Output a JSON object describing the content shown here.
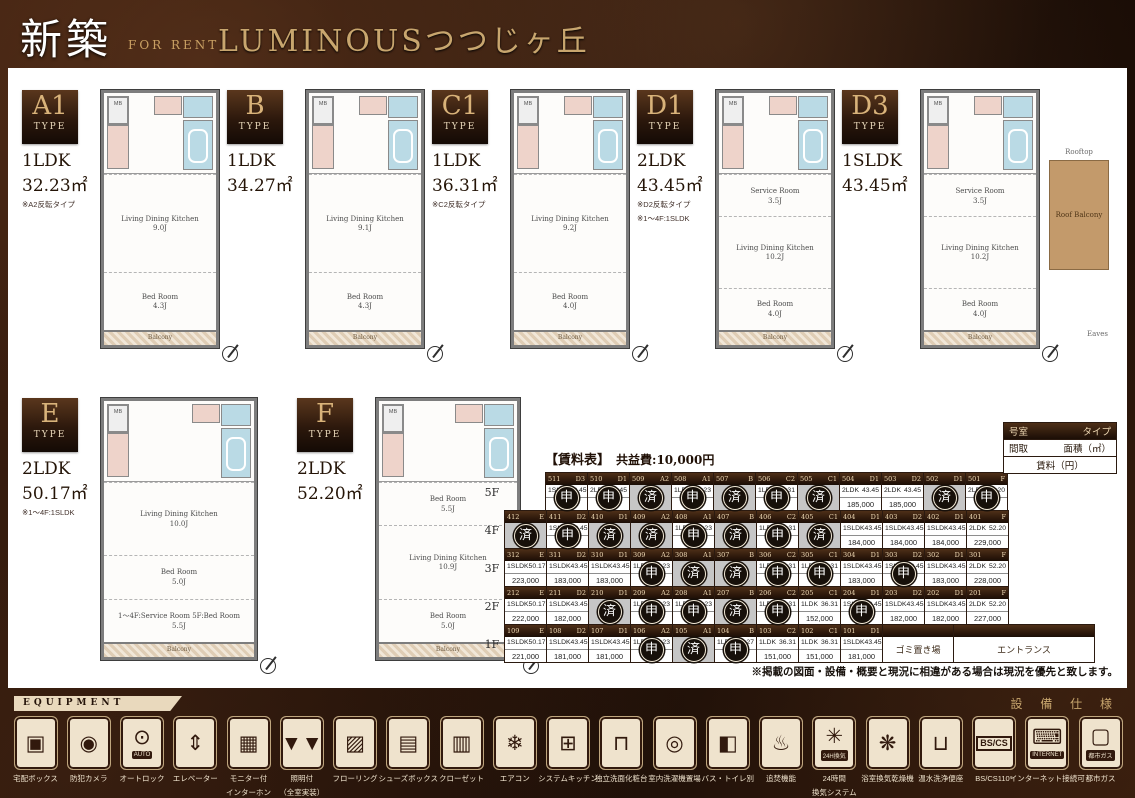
{
  "header": {
    "badge": "新築",
    "for_rent": "FOR RENT",
    "title": "LUMINOUSつつじヶ丘"
  },
  "plan_common": {
    "mb": "MB",
    "balcony": "Balcony"
  },
  "plans": [
    {
      "code": "A1",
      "type_word": "TYPE",
      "layout": "1LDK",
      "area": "32.23㎡",
      "notes": [
        "※A2反転タイプ"
      ],
      "rooms": [
        {
          "name": "Living Dining Kitchen",
          "size": "9.0J"
        },
        {
          "name": "Bed Room",
          "size": "4.3J"
        }
      ]
    },
    {
      "code": "B",
      "type_word": "TYPE",
      "layout": "1LDK",
      "area": "34.27㎡",
      "notes": [],
      "rooms": [
        {
          "name": "Living Dining Kitchen",
          "size": "9.1J"
        },
        {
          "name": "Bed Room",
          "size": "4.3J"
        }
      ]
    },
    {
      "code": "C1",
      "type_word": "TYPE",
      "layout": "1LDK",
      "area": "36.31㎡",
      "notes": [
        "※C2反転タイプ"
      ],
      "rooms": [
        {
          "name": "Living Dining Kitchen",
          "size": "9.2J"
        },
        {
          "name": "Bed Room",
          "size": "4.0J"
        }
      ]
    },
    {
      "code": "D1",
      "type_word": "TYPE",
      "layout": "2LDK",
      "area": "43.45㎡",
      "notes": [
        "※D2反転タイプ",
        "※1〜4F:1SLDK"
      ],
      "rooms": [
        {
          "name": "Service Room",
          "size": "3.5J"
        },
        {
          "name": "Living Dining Kitchen",
          "size": "10.2J"
        },
        {
          "name": "Bed Room",
          "size": "4.0J"
        }
      ]
    },
    {
      "code": "D3",
      "type_word": "TYPE",
      "layout": "1SLDK",
      "area": "43.45㎡",
      "notes": [],
      "rooms": [
        {
          "name": "Service Room",
          "size": "3.5J"
        },
        {
          "name": "Living Dining Kitchen",
          "size": "10.2J"
        },
        {
          "name": "Bed Room",
          "size": "4.0J"
        }
      ],
      "extras": {
        "rooftop": "Rooftop",
        "roof_balcony": "Roof Balcony",
        "eaves": "Eaves"
      }
    },
    {
      "code": "E",
      "type_word": "TYPE",
      "layout": "2LDK",
      "area": "50.17㎡",
      "notes": [
        "※1〜4F:1SLDK"
      ],
      "rooms": [
        {
          "name": "Living Dining Kitchen",
          "size": "10.0J"
        },
        {
          "name": "Bed Room",
          "size": "5.0J"
        },
        {
          "name": "1〜4F:Service Room 5F:Bed Room",
          "size": "5.5J"
        }
      ]
    },
    {
      "code": "F",
      "type_word": "TYPE",
      "layout": "2LDK",
      "area": "52.20㎡",
      "notes": [],
      "rooms": [
        {
          "name": "Bed Room",
          "size": "5.5J"
        },
        {
          "name": "Living Dining Kitchen",
          "size": "10.9J"
        },
        {
          "name": "Bed Room",
          "size": "5.0J"
        }
      ]
    }
  ],
  "price_table": {
    "title": "【賃料表】",
    "fee": "共益費:10,000円",
    "legend": {
      "room": "号室",
      "type": "タイプ",
      "madori": "間取",
      "area": "面積（㎡）",
      "rent": "賃料（円）"
    },
    "stamps": {
      "applied": "申",
      "taken": "済"
    },
    "floors": [
      {
        "label": "5F",
        "offset": true,
        "cells": [
          {
            "room": "511",
            "type": "D3",
            "layout": "1SLDK",
            "area": "43.45",
            "price": "",
            "status": "applied"
          },
          {
            "room": "510",
            "type": "D1",
            "layout": "2LDK",
            "area": "43.45",
            "price": "",
            "status": "applied"
          },
          {
            "room": "509",
            "type": "A2",
            "status": "taken"
          },
          {
            "room": "508",
            "type": "A1",
            "layout": "1LDK",
            "area": "32.23",
            "price": "",
            "status": "applied"
          },
          {
            "room": "507",
            "type": "B",
            "status": "taken"
          },
          {
            "room": "506",
            "type": "C2",
            "layout": "1LDK",
            "area": "36.31",
            "price": "",
            "status": "applied"
          },
          {
            "room": "505",
            "type": "C1",
            "status": "taken"
          },
          {
            "room": "504",
            "type": "D1",
            "layout": "2LDK",
            "area": "43.45",
            "price": "185,000",
            "status": "open"
          },
          {
            "room": "503",
            "type": "D2",
            "layout": "2LDK",
            "area": "43.45",
            "price": "185,000",
            "status": "open"
          },
          {
            "room": "502",
            "type": "D1",
            "status": "taken"
          },
          {
            "room": "501",
            "type": "F",
            "layout": "2LDK",
            "area": "52.20",
            "price": "",
            "status": "applied"
          }
        ]
      },
      {
        "label": "4F",
        "cells": [
          {
            "room": "412",
            "type": "E",
            "status": "taken"
          },
          {
            "room": "411",
            "type": "D2",
            "layout": "1SLDK",
            "area": "43.45",
            "price": "",
            "status": "applied"
          },
          {
            "room": "410",
            "type": "D1",
            "status": "taken"
          },
          {
            "room": "409",
            "type": "A2",
            "status": "taken"
          },
          {
            "room": "408",
            "type": "A1",
            "layout": "1LDK",
            "area": "32.23",
            "price": "",
            "status": "applied"
          },
          {
            "room": "407",
            "type": "B",
            "status": "taken"
          },
          {
            "room": "406",
            "type": "C2",
            "layout": "1LDK",
            "area": "36.31",
            "price": "",
            "status": "applied"
          },
          {
            "room": "405",
            "type": "C1",
            "status": "taken"
          },
          {
            "room": "404",
            "type": "D1",
            "layout": "1SLDK",
            "area": "43.45",
            "price": "184,000",
            "status": "open"
          },
          {
            "room": "403",
            "type": "D2",
            "layout": "1SLDK",
            "area": "43.45",
            "price": "184,000",
            "status": "open"
          },
          {
            "room": "402",
            "type": "D1",
            "layout": "1SLDK",
            "area": "43.45",
            "price": "184,000",
            "status": "open"
          },
          {
            "room": "401",
            "type": "F",
            "layout": "2LDK",
            "area": "52.20",
            "price": "229,000",
            "status": "open"
          }
        ]
      },
      {
        "label": "3F",
        "cells": [
          {
            "room": "312",
            "type": "E",
            "layout": "1SLDK",
            "area": "50.17",
            "price": "223,000",
            "status": "open"
          },
          {
            "room": "311",
            "type": "D2",
            "layout": "1SLDK",
            "area": "43.45",
            "price": "183,000",
            "status": "open"
          },
          {
            "room": "310",
            "type": "D1",
            "layout": "1SLDK",
            "area": "43.45",
            "price": "183,000",
            "status": "open"
          },
          {
            "room": "309",
            "type": "A2",
            "layout": "1LDK",
            "area": "32.23",
            "price": "",
            "status": "applied"
          },
          {
            "room": "308",
            "type": "A1",
            "status": "taken"
          },
          {
            "room": "307",
            "type": "B",
            "status": "taken"
          },
          {
            "room": "306",
            "type": "C2",
            "layout": "1LDK",
            "area": "36.31",
            "price": "",
            "status": "applied"
          },
          {
            "room": "305",
            "type": "C1",
            "layout": "1LDK",
            "area": "36.31",
            "price": "",
            "status": "applied"
          },
          {
            "room": "304",
            "type": "D1",
            "layout": "1SLDK",
            "area": "43.45",
            "price": "183,000",
            "status": "open"
          },
          {
            "room": "303",
            "type": "D2",
            "layout": "1SLDK",
            "area": "43.45",
            "price": "",
            "status": "applied"
          },
          {
            "room": "302",
            "type": "D1",
            "layout": "1SLDK",
            "area": "43.45",
            "price": "183,000",
            "status": "open"
          },
          {
            "room": "301",
            "type": "F",
            "layout": "2LDK",
            "area": "52.20",
            "price": "228,000",
            "status": "open"
          }
        ]
      },
      {
        "label": "2F",
        "cells": [
          {
            "room": "212",
            "type": "E",
            "layout": "1SLDK",
            "area": "50.17",
            "price": "222,000",
            "status": "open"
          },
          {
            "room": "211",
            "type": "D2",
            "layout": "1SLDK",
            "area": "43.45",
            "price": "182,000",
            "status": "open"
          },
          {
            "room": "210",
            "type": "D1",
            "status": "taken"
          },
          {
            "room": "209",
            "type": "A2",
            "layout": "1LDK",
            "area": "32.23",
            "price": "",
            "status": "applied"
          },
          {
            "room": "208",
            "type": "A1",
            "layout": "1LDK",
            "area": "32.23",
            "price": "",
            "status": "applied"
          },
          {
            "room": "207",
            "type": "B",
            "status": "taken"
          },
          {
            "room": "206",
            "type": "C2",
            "layout": "1LDK",
            "area": "36.31",
            "price": "",
            "status": "applied"
          },
          {
            "room": "205",
            "type": "C1",
            "layout": "1LDK",
            "area": "36.31",
            "price": "152,000",
            "status": "open"
          },
          {
            "room": "204",
            "type": "D1",
            "layout": "1SLDK",
            "area": "43.45",
            "price": "",
            "status": "applied"
          },
          {
            "room": "203",
            "type": "D2",
            "layout": "1SLDK",
            "area": "43.45",
            "price": "182,000",
            "status": "open"
          },
          {
            "room": "202",
            "type": "D1",
            "layout": "1SLDK",
            "area": "43.45",
            "price": "182,000",
            "status": "open"
          },
          {
            "room": "201",
            "type": "F",
            "layout": "2LDK",
            "area": "52.20",
            "price": "227,000",
            "status": "open"
          }
        ]
      },
      {
        "label": "1F",
        "cells": [
          {
            "room": "109",
            "type": "E",
            "layout": "1SLDK",
            "area": "50.17",
            "price": "221,000",
            "status": "open"
          },
          {
            "room": "108",
            "type": "D2",
            "layout": "1SLDK",
            "area": "43.45",
            "price": "181,000",
            "status": "open"
          },
          {
            "room": "107",
            "type": "D1",
            "layout": "1SLDK",
            "area": "43.45",
            "price": "181,000",
            "status": "open"
          },
          {
            "room": "106",
            "type": "A2",
            "layout": "1LDK",
            "area": "32.23",
            "price": "",
            "status": "applied"
          },
          {
            "room": "105",
            "type": "A1",
            "status": "taken"
          },
          {
            "room": "104",
            "type": "B",
            "layout": "1LDK",
            "area": "34.27",
            "price": "",
            "status": "applied"
          },
          {
            "room": "103",
            "type": "C2",
            "layout": "1LDK",
            "area": "36.31",
            "price": "151,000",
            "status": "open"
          },
          {
            "room": "102",
            "type": "C1",
            "layout": "1LDK",
            "area": "36.31",
            "price": "151,000",
            "status": "open"
          },
          {
            "room": "101",
            "type": "D1",
            "layout": "1SLDK",
            "area": "43.45",
            "price": "181,000",
            "status": "open"
          },
          {
            "label": "ゴミ置き場",
            "status": "special",
            "wide": 1
          },
          {
            "label": "エントランス",
            "status": "special",
            "wide": 2
          }
        ]
      }
    ]
  },
  "note": "※掲載の図面・設備・概要と現況に相違がある場合は現況を優先と致します。",
  "equipment": {
    "banner": "EQUIPMENT",
    "right_label": "設 備 仕 様",
    "items": [
      {
        "icon": "delivery-box-icon",
        "glyph": "▣",
        "label": "宅配ボックス"
      },
      {
        "icon": "security-camera-icon",
        "glyph": "◉",
        "label": "防犯カメラ"
      },
      {
        "icon": "auto-lock-icon",
        "glyph": "⊙",
        "badge": "AUTO",
        "label": "オートロック"
      },
      {
        "icon": "elevator-icon",
        "glyph": "⇕",
        "label": "エレベーター"
      },
      {
        "icon": "monitor-intercom-icon",
        "glyph": "▦",
        "label": "モニター付",
        "label2": "インターホン"
      },
      {
        "icon": "lighting-icon",
        "glyph": "▼▼",
        "label": "照明付",
        "label2": "（全室実装）"
      },
      {
        "icon": "flooring-icon",
        "glyph": "▨",
        "label": "フローリング"
      },
      {
        "icon": "shoe-box-icon",
        "glyph": "▤",
        "label": "シューズボックス"
      },
      {
        "icon": "closet-icon",
        "glyph": "▥",
        "label": "クローゼット"
      },
      {
        "icon": "air-conditioner-icon",
        "glyph": "❄",
        "label": "エアコン"
      },
      {
        "icon": "system-kitchen-icon",
        "glyph": "⊞",
        "label": "システムキッチン"
      },
      {
        "icon": "washbasin-icon",
        "glyph": "⊓",
        "label": "独立洗面化粧台"
      },
      {
        "icon": "washing-machine-icon",
        "glyph": "◎",
        "label": "室内洗濯機置場"
      },
      {
        "icon": "separate-bath-toilet-icon",
        "glyph": "◧",
        "label": "バス・トイレ別"
      },
      {
        "icon": "reheating-icon",
        "glyph": "♨",
        "label": "追焚機能"
      },
      {
        "icon": "ventilation-24h-icon",
        "glyph": "✳",
        "badge": "24H換気",
        "label": "24時間",
        "label2": "換気システム"
      },
      {
        "icon": "bathroom-dryer-icon",
        "glyph": "❋",
        "label": "浴室換気乾燥機"
      },
      {
        "icon": "washlet-icon",
        "glyph": "⊔",
        "label": "温水洗浄便座"
      },
      {
        "icon": "bs-cs-icon",
        "glyph": "BS/CS",
        "label": "BS/CS110°"
      },
      {
        "icon": "internet-icon",
        "glyph": "⌨",
        "badge": "INTERNET",
        "label": "インターネット接続可"
      },
      {
        "icon": "city-gas-icon",
        "glyph": "▢",
        "badge": "都市ガス",
        "label": "都市ガス"
      }
    ]
  }
}
